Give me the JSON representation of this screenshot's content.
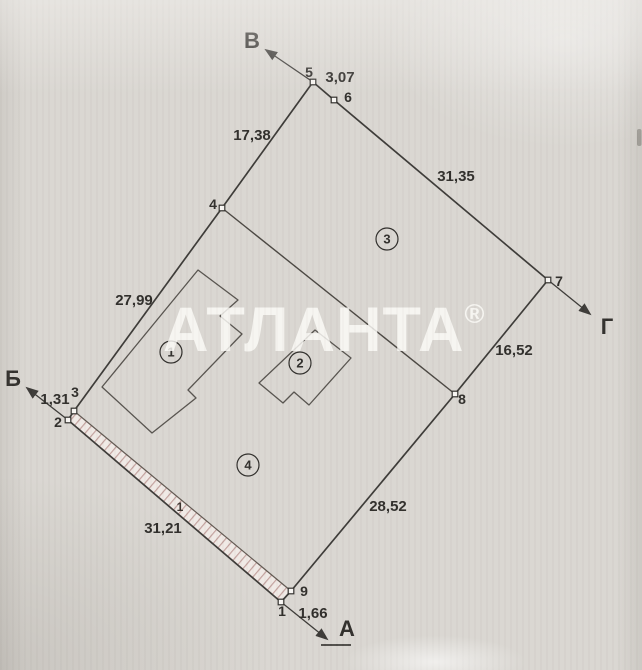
{
  "watermark": {
    "text": "АТЛАНТА",
    "registered": "®"
  },
  "palette": {
    "paper": "#d9d6d1",
    "line": "#3a3835",
    "hatch_pink": "#c2a09c",
    "watermark_white": "#fcfbf8"
  },
  "plan": {
    "direction_rays": {
      "north": "В",
      "east": "Г",
      "west": "Б",
      "south": "А"
    },
    "points": {
      "p1": "1",
      "p2": "2",
      "p3": "3",
      "p4": "4",
      "p5": "5",
      "p6": "6",
      "p7": "7",
      "p8": "8",
      "p9": "9"
    },
    "edge_lengths": {
      "p5_p6": "3,07",
      "p6_p7": "31,35",
      "p7_p8": "16,52",
      "p8_p9": "28,52",
      "p9_p1": "1,66",
      "p1_p2": "31,21",
      "p2_p3": "1,31",
      "p3_p4": "27,99",
      "p4_p5": "17,38"
    },
    "regions": {
      "r1": "1",
      "r2": "2",
      "r3": "3",
      "r4": "4"
    },
    "fence_section_marker": "1"
  }
}
